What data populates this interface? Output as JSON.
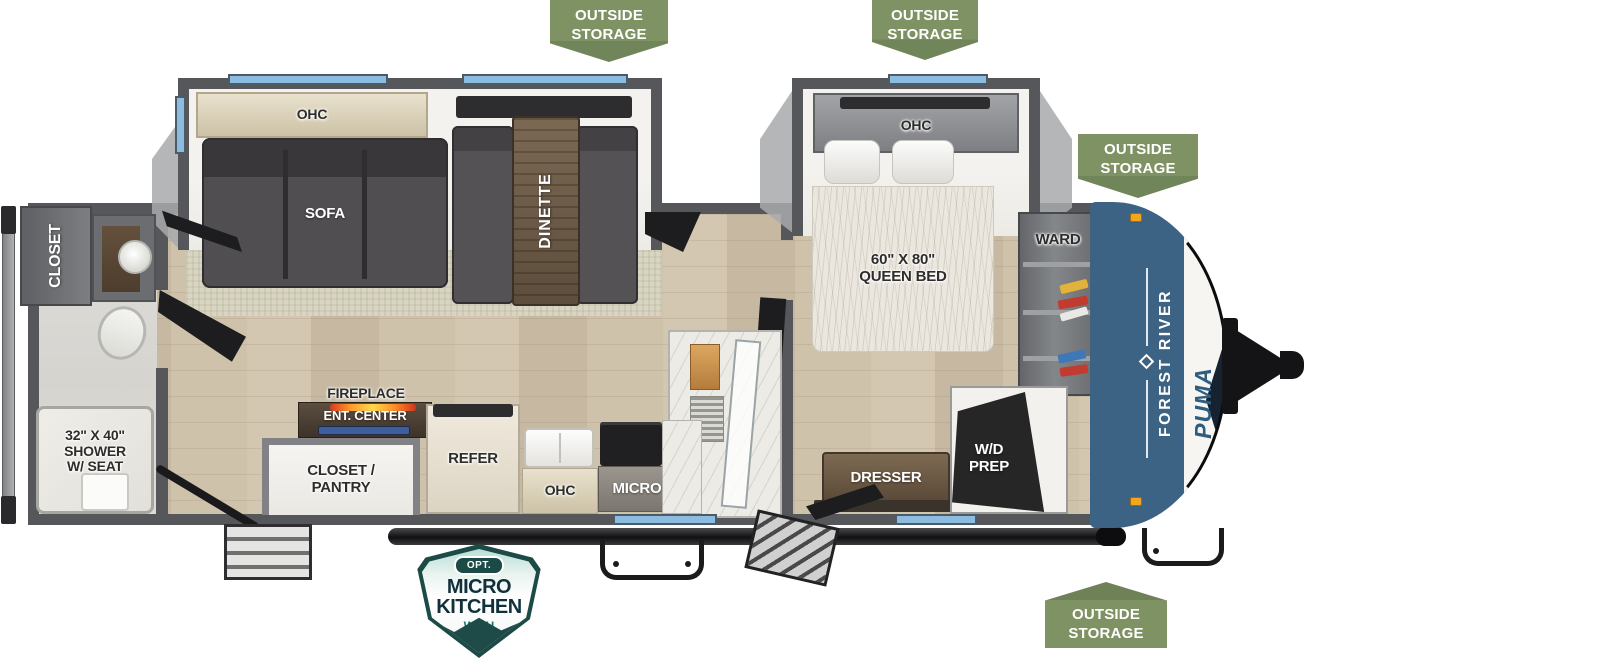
{
  "colors": {
    "badge_green": "#7f9264",
    "wall_gray": "#56575a",
    "window_blue": "#8cbcdf",
    "cap_blue": "#3c6384",
    "accent_orange": "#f2a71f",
    "option_teal": "#1c4a47",
    "floor_wood": "#cfc2aa"
  },
  "badges": {
    "outside_storage": "OUTSIDE STORAGE"
  },
  "option_badge": {
    "opt": "OPT.",
    "title": "MICRO KITCHEN",
    "subtitle": "WITH GRIDDLE"
  },
  "exterior": {
    "brand": "FOREST RIVER",
    "model": "PUMA"
  },
  "living": {
    "ohc": "OHC",
    "sofa": "SOFA",
    "dinette": "DINETTE"
  },
  "kitchen": {
    "fireplace": "FIREPLACE",
    "ent_center": "ENT. CENTER",
    "closet_pantry": "CLOSET / PANTRY",
    "refer": "REFER",
    "ohc": "OHC",
    "micro": "MICRO"
  },
  "bedroom": {
    "ohc": "OHC",
    "queen_bed": "60\" X 80\" QUEEN BED",
    "ward": "WARD",
    "dresser": "DRESSER",
    "wd_prep": "W/D PREP"
  },
  "rear_bath": {
    "closet": "CLOSET",
    "shower": "32\" X 40\" SHOWER W/ SEAT"
  }
}
